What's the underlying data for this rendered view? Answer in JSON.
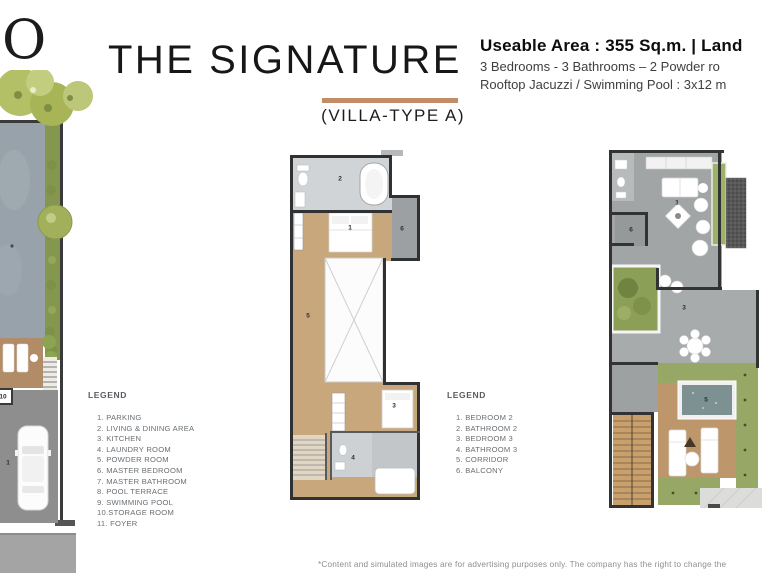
{
  "header": {
    "logo_partial_letter": "O",
    "title": "THE SIGNATURE",
    "subtitle": "(VILLA-TYPE A)",
    "underline_color": "#c18c67",
    "info": {
      "line1": "Useable Area : 355 Sq.m. | Land",
      "line2": "3 Bedrooms - 3 Bathrooms – 2 Powder ro",
      "line3": "Rooftop Jacuzzi / Swimming Pool : 3x12 m"
    }
  },
  "legends": [
    {
      "title": "LEGEND",
      "items": [
        "1. PARKING",
        "2. LIVING & DINING AREA",
        "3. KITCHEN",
        "4. LAUNDRY ROOM",
        "5. POWDER ROOM",
        "6. MASTER BEDROOM",
        "7. MASTER BATHROOM",
        "8. POOL TERRACE",
        "9. SWIMMING POOL",
        "10.STORAGE ROOM",
        "11. FOYER"
      ]
    },
    {
      "title": "LEGEND",
      "items": [
        "1. BEDROOM 2",
        "2. BATHROOM 2",
        "3. BEDROOM 3",
        "4. BATHROOM 3",
        "5. CORRIDOR",
        "6. BALCONY"
      ]
    }
  ],
  "plans": [
    {
      "name": "ground-floor-site-plan",
      "markers": [
        {
          "label": "10",
          "x": 3,
          "y": 397
        },
        {
          "label": "1",
          "x": 8,
          "y": 463
        }
      ]
    },
    {
      "name": "second-floor-plan",
      "markers": [
        {
          "label": "2",
          "x": 340,
          "y": 179
        },
        {
          "label": "1",
          "x": 350,
          "y": 228
        },
        {
          "label": "6",
          "x": 402,
          "y": 229
        },
        {
          "label": "5",
          "x": 308,
          "y": 316
        },
        {
          "label": "3",
          "x": 394,
          "y": 406
        },
        {
          "label": "4",
          "x": 353,
          "y": 458
        }
      ]
    },
    {
      "name": "rooftop-plan",
      "markers": [
        {
          "label": "1",
          "x": 677,
          "y": 203
        },
        {
          "label": "6",
          "x": 631,
          "y": 230
        },
        {
          "label": "3",
          "x": 684,
          "y": 308
        },
        {
          "label": "5",
          "x": 706,
          "y": 400
        }
      ]
    }
  ],
  "colors": {
    "accent_underline": "#c18c67",
    "pool_water": "#98a2aa",
    "jacuzzi_water": "#7d9193",
    "wood_floor": "#c9a77c",
    "grass": "#97a765",
    "wall": "#333333"
  },
  "footer": {
    "disclaimer": "*Content and simulated images are for advertising purposes only. The company has the right to change the"
  }
}
